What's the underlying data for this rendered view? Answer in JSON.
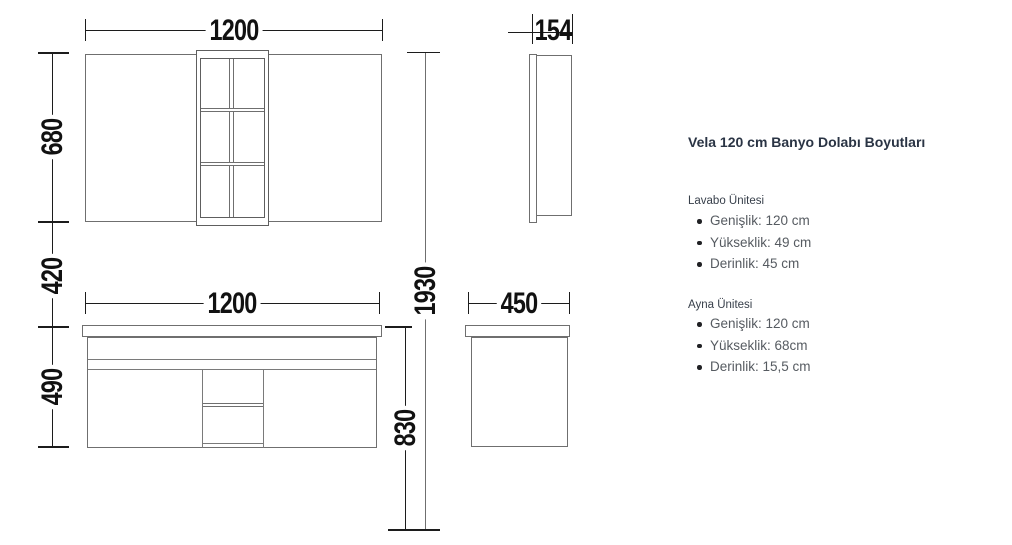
{
  "colors": {
    "title_text": "#2a3444",
    "body_text": "#565b61",
    "shape_line": "#6f6f6f",
    "dimension_line": "#1c1c1c",
    "background": "#ffffff"
  },
  "dims": {
    "mirror_width": "1200",
    "mirror_depth": "154",
    "mirror_height": "680",
    "wall_gap": "420",
    "vanity_height": "490",
    "vanity_width": "1200",
    "vanity_depth": "450",
    "total_height": "1930",
    "vanity_top_height": "830"
  },
  "info": {
    "title": "Vela 120 cm Banyo Dolabı Boyutları",
    "sections": [
      {
        "heading": "Lavabo Ünitesi",
        "items": [
          "Genişlik: 120 cm",
          "Yükseklik: 49 cm",
          "Derinlik: 45 cm"
        ]
      },
      {
        "heading": "Ayna Ünitesi",
        "items": [
          "Genişlik: 120 cm",
          "Yükseklik: 68cm",
          "Derinlik: 15,5 cm"
        ]
      }
    ]
  }
}
